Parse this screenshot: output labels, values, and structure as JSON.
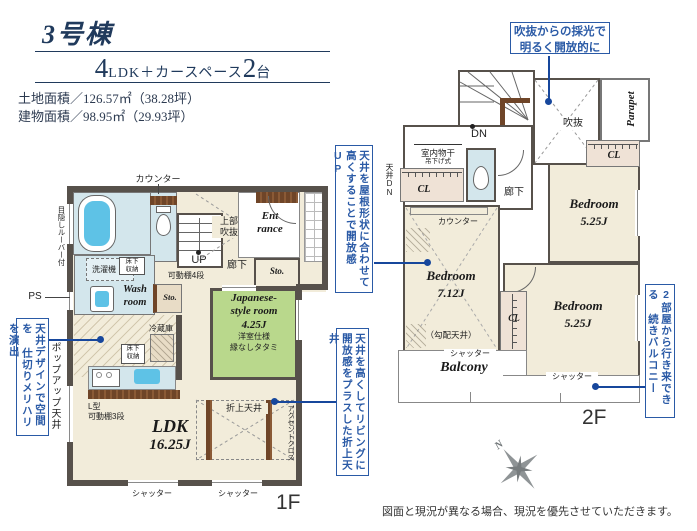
{
  "colors": {
    "accent": "#2a5aa6",
    "line": "#17479c",
    "navy": "#203a5c",
    "wall": "#57514b",
    "cream": "#f2ecda",
    "aqua": "#d3e6ec",
    "green": "#b9d88c",
    "clbg": "#efe2d6",
    "tub": "#5ec2e6",
    "compass": "#8f9496"
  },
  "header": {
    "building": "3号棟",
    "big1": "4",
    "mid": "LDK＋カースペース",
    "big2": "2",
    "tail": "台",
    "land": "土地面積／126.57㎡（38.28坪）",
    "house": "建物面積／98.95㎡（29.93坪）"
  },
  "callouts": {
    "atrium": "吹抜からの採光で\n明るく開放的に",
    "roof1": "天井を屋根形状に合わせて",
    "roof2": "高くすることで開放感UP",
    "design1": "天井デザインで空間を",
    "design2": "仕切りメリハリを演出",
    "coffered1": "天井を高くしてリビングに",
    "coffered2": "開放感をプラスした折上天井",
    "balcony1": "2部屋から行き来できる",
    "balcony2": "続きバルコニー"
  },
  "floor1": {
    "label": "1F",
    "counter": "カウンター",
    "louver": "目隠しルーバー付",
    "ps": "PS",
    "popup": "ポップアップ天井",
    "bath": "Bath\nroom",
    "wash": "Wash\nroom",
    "washer": "洗濯機",
    "underfloor": "床下\n収納",
    "underfloor2": "床下\n収納",
    "shelf4": "可動棚4段",
    "sto1": "Sto.",
    "sto2": "Sto.",
    "corridor": "廊下",
    "upper_void": "上部\n吹抜",
    "up": "UP",
    "entrance": "Ent\nrance",
    "jp_name": "Japanese-\nstyle room",
    "jp_size": "4.25J",
    "jp_n1": "洋室仕様",
    "jp_n2": "縁なしタタミ",
    "fridge": "冷蔵庫",
    "lshelf": "L型\n可動棚3段",
    "ldk": "LDK",
    "ldk_size": "16.25J",
    "coffered": "折上天井",
    "accent_cloth": "アクセントクロス",
    "shutter1": "シャッター",
    "shutter2": "シャッター"
  },
  "floor2": {
    "label": "2F",
    "dn": "DN",
    "void": "吹抜",
    "parapet": "Parapet",
    "drying": "室内物干",
    "drying2": "吊下げ式",
    "ceiling_dn": "天井DN",
    "corridor": "廊下",
    "counter": "カウンター",
    "cl1": "CL",
    "cl2": "CL",
    "cl3": "CL",
    "bed1": "Bedroom",
    "bed1_size": "7.12J",
    "sloped": "（勾配天井）",
    "bed2": "Bedroom",
    "bed2_size": "5.25J",
    "bed3": "Bedroom",
    "bed3_size": "5.25J",
    "balcony": "Balcony",
    "shutter1": "シャッター",
    "shutter2": "シャッター"
  },
  "compass": {
    "n": "N"
  },
  "disclaimer": "図面と現況が異なる場合、現況を優先させていただきます。"
}
